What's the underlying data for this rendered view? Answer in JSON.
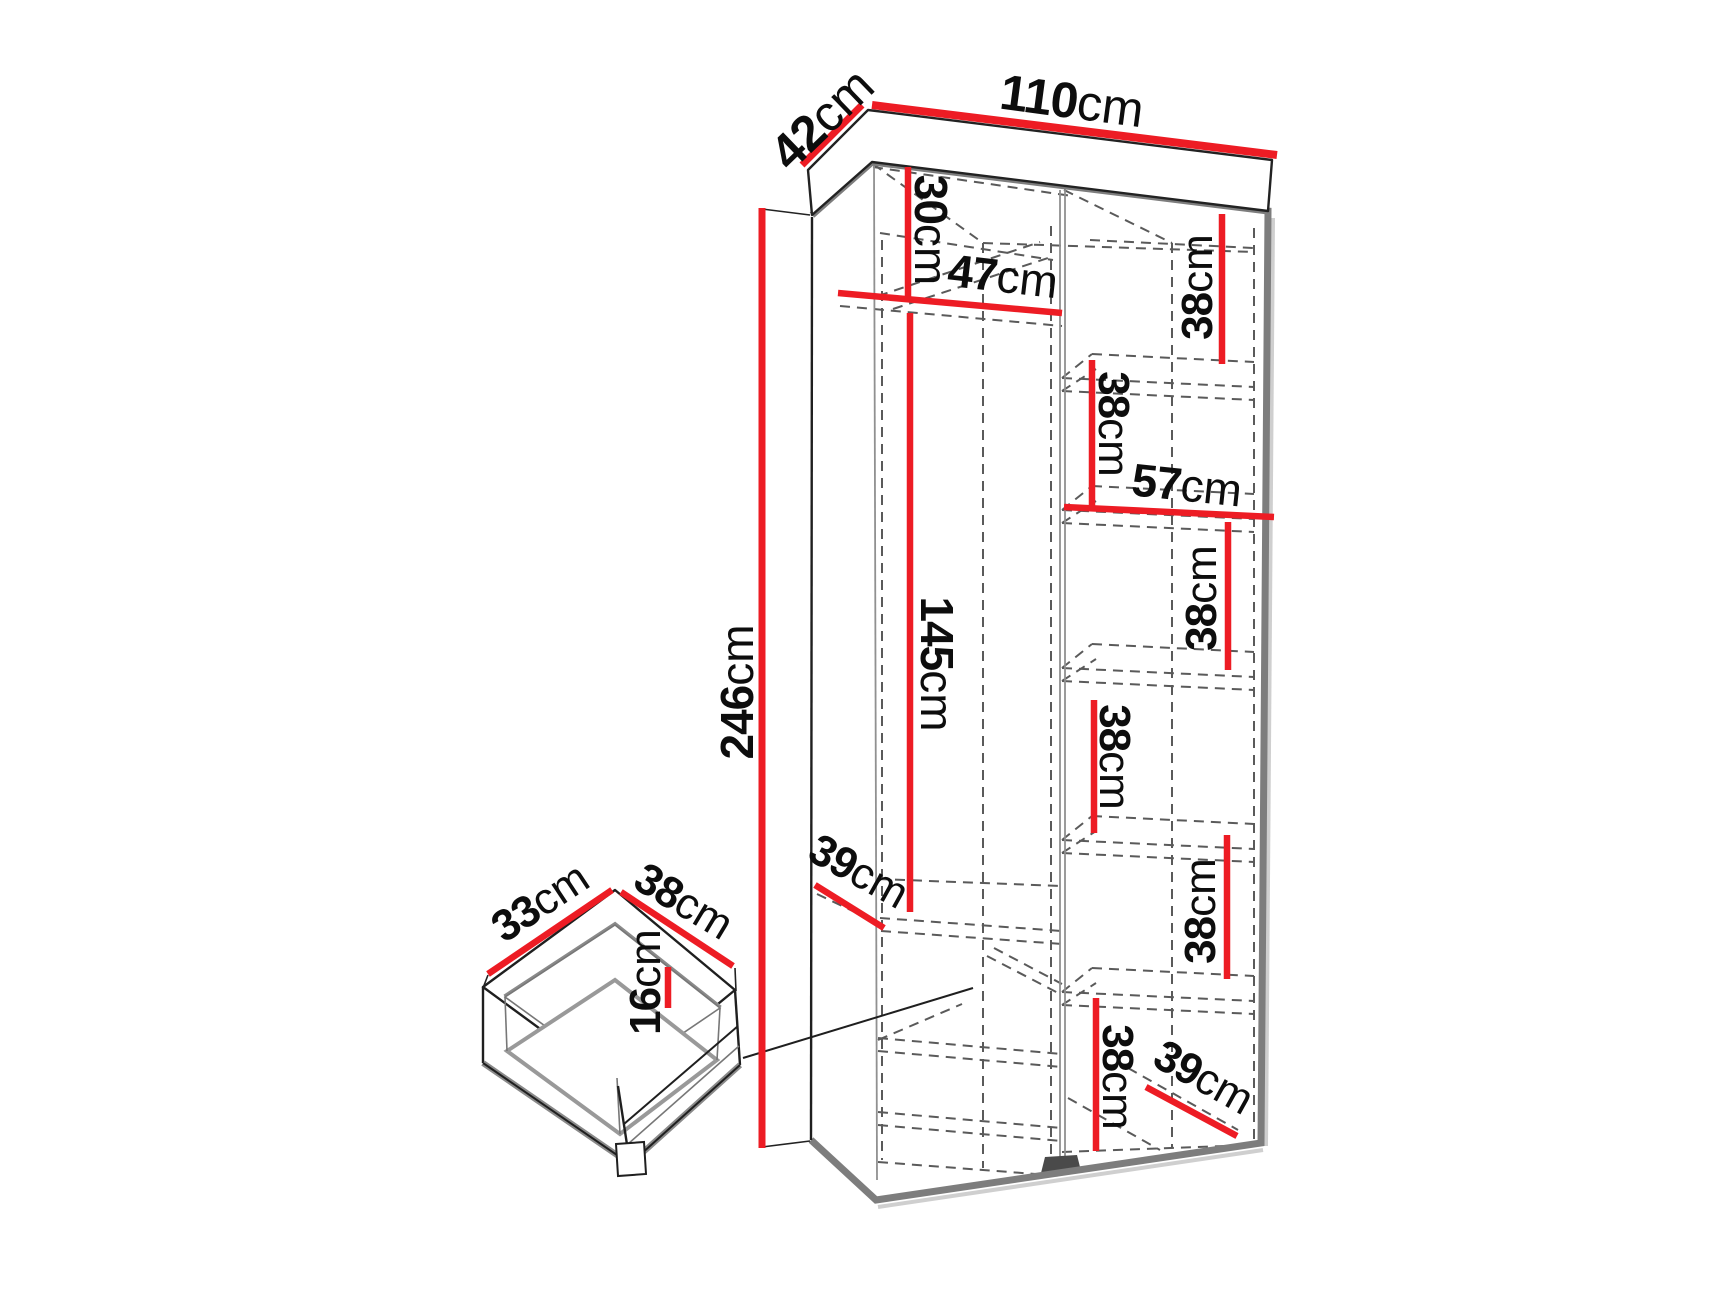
{
  "unit": "cm",
  "colors": {
    "dimension_red": "#ED1C24",
    "outline_gray": "#7d7d7d",
    "dash_gray": "#5a5a5a",
    "text_black": "#0d0d0d"
  },
  "wardrobe": {
    "width": "110",
    "depth": "42",
    "height": "246",
    "top_compartment_height": "30",
    "left_section_width": "47",
    "hanging_space_height": "145",
    "right_section_width": "57",
    "left_shelf_depth": "39",
    "bottom_shelf_depth": "39",
    "right_shelf_heights": [
      "38",
      "38",
      "38",
      "38",
      "38",
      "38"
    ]
  },
  "drawer": {
    "width": "33",
    "depth": "38",
    "height": "16"
  }
}
